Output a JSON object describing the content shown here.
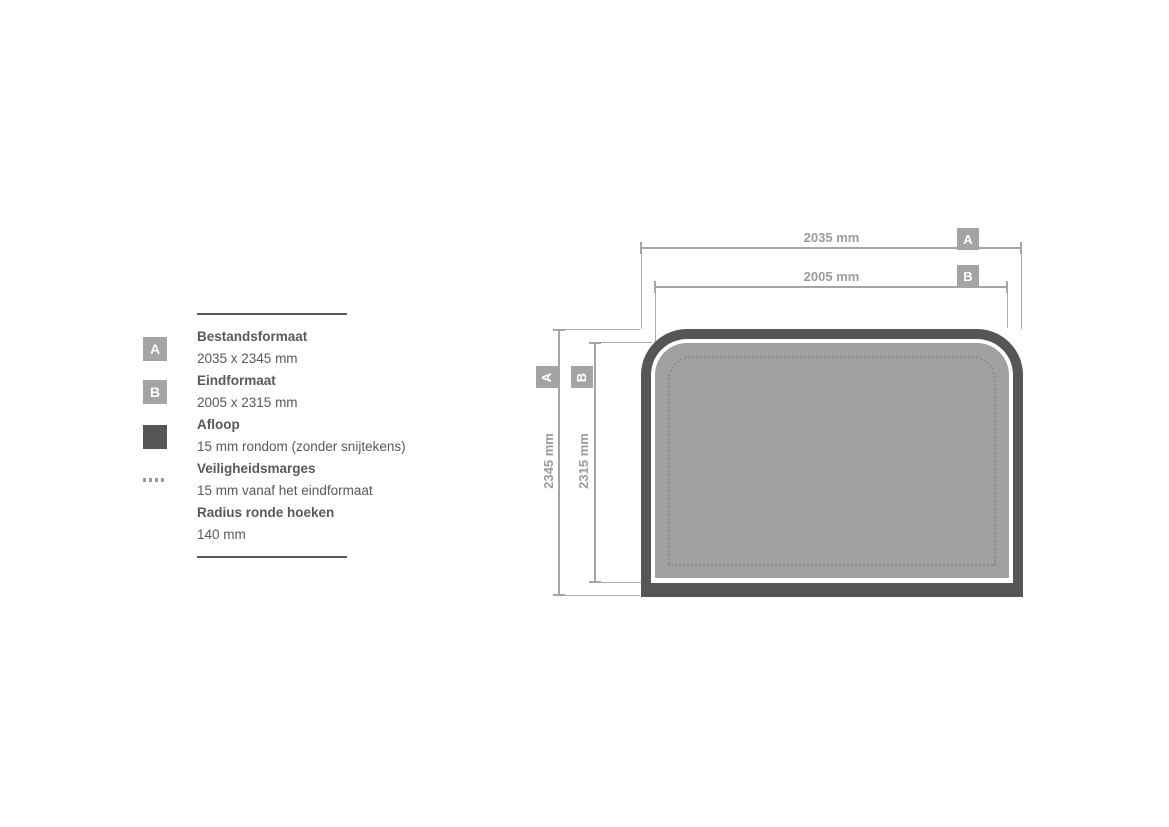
{
  "colors": {
    "bleed_dark": "#565656",
    "shape_fill": "#a0a0a0",
    "marker_box_gray": "#a4a4a4",
    "dimension_gray": "#a5a5a5",
    "dimension_text_gray": "#9b9b9b",
    "legend_text_gray": "#59595b",
    "safety_dotted_gray": "#8b8b8b",
    "background": "#ffffff"
  },
  "legend": {
    "items": [
      {
        "label": "A",
        "title": "Bestandsformaat",
        "value": "2035 x 2345 mm"
      },
      {
        "label": "B",
        "title": "Eindformaat",
        "value": "2005 x 2315 mm"
      },
      {
        "title": "Afloop",
        "value": "15 mm rondom (zonder snijtekens)"
      },
      {
        "title": "Veiligheidsmarges",
        "value": "15 mm vanaf het eindformaat"
      },
      {
        "title": "Radius ronde hoeken",
        "value": "140 mm"
      }
    ]
  },
  "diagram": {
    "marker_a": "A",
    "marker_b": "B",
    "width_a": "2035 mm",
    "width_b": "2005 mm",
    "height_a": "2345 mm",
    "height_b": "2315 mm"
  }
}
